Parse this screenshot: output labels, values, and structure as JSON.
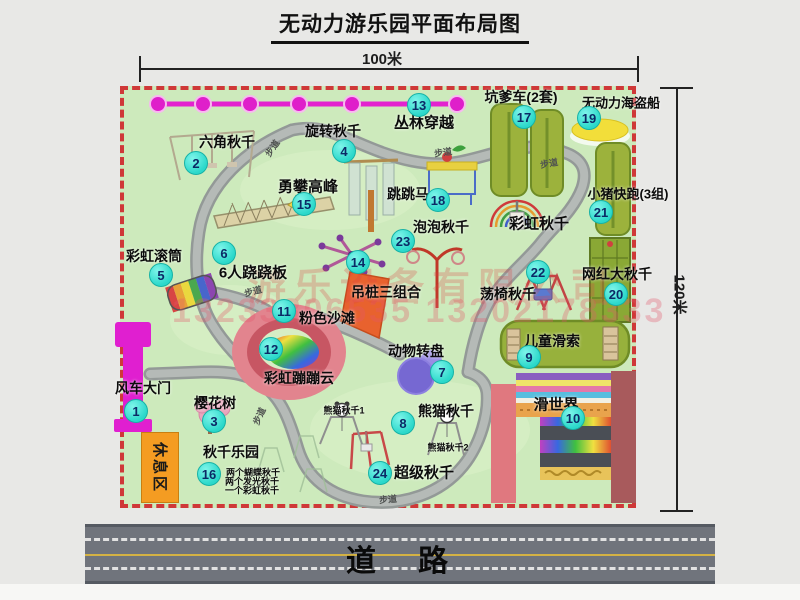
{
  "title": "无动力游乐园平面布局图",
  "dimensions": {
    "width_label": "100米",
    "height_label": "120米"
  },
  "road": {
    "label": "道　路"
  },
  "rest_area": {
    "label": "休息区"
  },
  "watermark": {
    "line1": "游乐设备有限公司",
    "line2": "13233806535 13202178333"
  },
  "palette": {
    "map_green": "#cdeabc",
    "border_red": "#cf3838",
    "badge_cyan": "#2bd8ca",
    "path_gray": "#9aa09e",
    "zipline_magenta": "#e322cf",
    "gate_magenta": "#e01fd0",
    "road_gray": "#70747c",
    "rest_orange": "#f49c22",
    "watermark_red": "#e14646",
    "attraction_olive": "#9cb23c",
    "pirate_yellow": "#f2de3a",
    "carousel_purple": "#7668d2",
    "beach_pink": "#e2848e"
  },
  "locations": [
    {
      "num": "1",
      "name": "风车大门",
      "label": {
        "x": 143,
        "y": 388
      },
      "badge": {
        "x": 136,
        "y": 411
      }
    },
    {
      "num": "2",
      "name": "六角秋千",
      "label": {
        "x": 227,
        "y": 142
      },
      "badge": {
        "x": 196,
        "y": 163
      }
    },
    {
      "num": "3",
      "name": "樱花树",
      "label": {
        "x": 215,
        "y": 403
      },
      "badge": {
        "x": 214,
        "y": 421
      }
    },
    {
      "num": "4",
      "name": "旋转秋千",
      "label": {
        "x": 333,
        "y": 131
      },
      "badge": {
        "x": 344,
        "y": 151
      }
    },
    {
      "num": "5",
      "name": "彩虹滚筒",
      "label": {
        "x": 154,
        "y": 256
      },
      "badge": {
        "x": 161,
        "y": 275
      }
    },
    {
      "num": "6",
      "name": "6人跷跷板",
      "label": {
        "x": 253,
        "y": 272,
        "fs": 15
      },
      "badge": {
        "x": 224,
        "y": 253
      }
    },
    {
      "num": "7",
      "name": "动物转盘",
      "label": {
        "x": 416,
        "y": 351
      },
      "badge": {
        "x": 442,
        "y": 372
      }
    },
    {
      "num": "8",
      "name": "熊猫秋千",
      "label": {
        "x": 446,
        "y": 411
      },
      "badge": {
        "x": 403,
        "y": 423
      }
    },
    {
      "num": "9",
      "name": "儿童滑索",
      "label": {
        "x": 552,
        "y": 341
      },
      "badge": {
        "x": 529,
        "y": 357
      }
    },
    {
      "num": "10",
      "name": "滑世界",
      "label": {
        "x": 556,
        "y": 404,
        "fs": 15
      },
      "badge": {
        "x": 573,
        "y": 418
      }
    },
    {
      "num": "11",
      "name": "粉色沙滩",
      "label": {
        "x": 327,
        "y": 318
      },
      "badge": {
        "x": 284,
        "y": 311
      }
    },
    {
      "num": "12",
      "name": "彩虹蹦蹦云",
      "label": {
        "x": 299,
        "y": 378
      },
      "badge": {
        "x": 271,
        "y": 349
      }
    },
    {
      "num": "13",
      "name": "丛林穿越",
      "label": {
        "x": 424,
        "y": 122,
        "fs": 15
      },
      "badge": {
        "x": 419,
        "y": 105
      }
    },
    {
      "num": "14",
      "name": "吊桩三组合",
      "label": {
        "x": 386,
        "y": 292
      },
      "badge": {
        "x": 358,
        "y": 262
      }
    },
    {
      "num": "15",
      "name": "勇攀高峰",
      "label": {
        "x": 308,
        "y": 186,
        "fs": 15
      },
      "badge": {
        "x": 304,
        "y": 204
      }
    },
    {
      "num": "16",
      "name": "秋千乐园",
      "label": {
        "x": 231,
        "y": 452
      },
      "badge": {
        "x": 209,
        "y": 474
      }
    },
    {
      "num": "17",
      "name": "坑爹车(2套)",
      "label": {
        "x": 521,
        "y": 97
      },
      "badge": {
        "x": 524,
        "y": 117
      }
    },
    {
      "num": "18",
      "name": "跳跳马",
      "label": {
        "x": 408,
        "y": 194
      },
      "badge": {
        "x": 438,
        "y": 200
      }
    },
    {
      "num": "19",
      "name": "无动力海盗船",
      "label": {
        "x": 621,
        "y": 102,
        "fs": 13
      },
      "badge": {
        "x": 589,
        "y": 118
      }
    },
    {
      "num": "20",
      "name": "网红大秋千",
      "label": {
        "x": 617,
        "y": 274
      },
      "badge": {
        "x": 616,
        "y": 294
      }
    },
    {
      "num": "21",
      "name": "小猪快跑(3组)",
      "label": {
        "x": 628,
        "y": 193,
        "fs": 13
      },
      "badge": {
        "x": 601,
        "y": 212
      }
    },
    {
      "num": "22",
      "name": "荡椅秋千",
      "label": {
        "x": 508,
        "y": 294
      },
      "badge": {
        "x": 538,
        "y": 272
      }
    },
    {
      "num": "23",
      "name": "泡泡秋千",
      "label": {
        "x": 441,
        "y": 227
      },
      "badge": {
        "x": 403,
        "y": 241
      }
    },
    {
      "num": "24",
      "name": "超级秋千",
      "label": {
        "x": 424,
        "y": 472,
        "fs": 15
      },
      "badge": {
        "x": 380,
        "y": 473
      }
    }
  ],
  "extra_labels": [
    {
      "text": "彩虹秋千",
      "x": 539,
      "y": 223,
      "fs": 15
    },
    {
      "text": "熊猫秋千1",
      "x": 344,
      "y": 410,
      "fs": 9
    },
    {
      "text": "熊猫秋千2",
      "x": 448,
      "y": 447,
      "fs": 9
    },
    {
      "text": "两个蝴蝶秋千",
      "x": 253,
      "y": 472,
      "fs": 9
    },
    {
      "text": "两个发光秋千",
      "x": 252,
      "y": 481,
      "fs": 9
    },
    {
      "text": "一个彩虹秋千",
      "x": 252,
      "y": 490,
      "fs": 9
    }
  ],
  "path_labels": [
    {
      "text": "步道",
      "x": 272,
      "y": 148,
      "rot": -55
    },
    {
      "text": "步道",
      "x": 443,
      "y": 152,
      "rot": -8
    },
    {
      "text": "步道",
      "x": 549,
      "y": 163,
      "rot": -10
    },
    {
      "text": "步道",
      "x": 253,
      "y": 291,
      "rot": -15
    },
    {
      "text": "步道",
      "x": 388,
      "y": 499,
      "rot": -5
    },
    {
      "text": "步道",
      "x": 259,
      "y": 416,
      "rot": -65
    }
  ]
}
